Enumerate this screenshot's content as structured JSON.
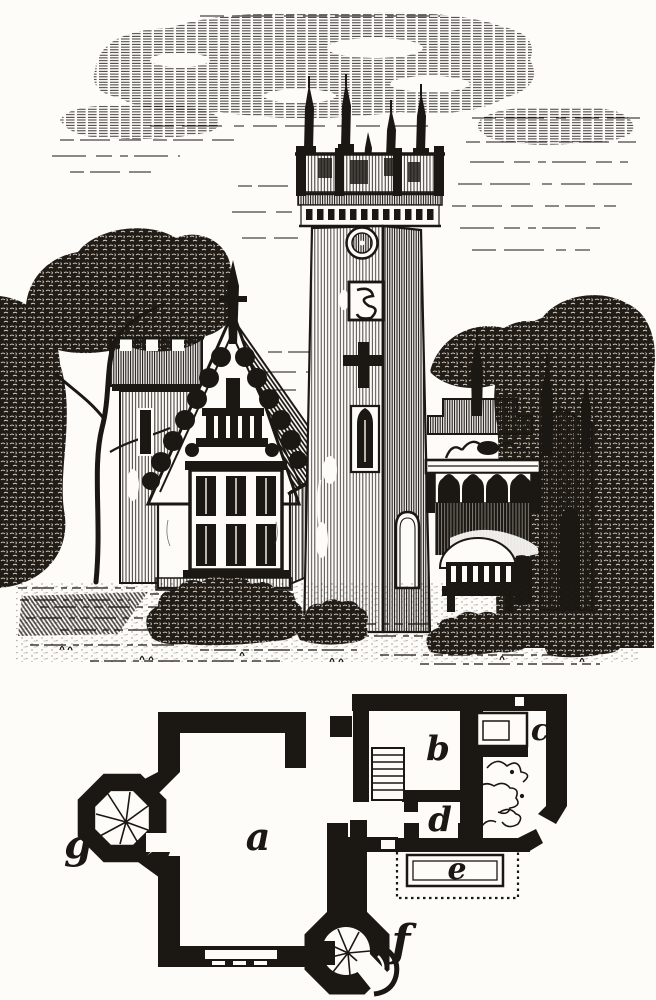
{
  "figure": {
    "kind": "wood-engraving of a Gothic lodge with clock tower, above its ground-floor plan",
    "ink": "#1b1713",
    "paper": "#fdfcf9"
  },
  "plan": {
    "labels": [
      {
        "letter": "a"
      },
      {
        "letter": "b"
      },
      {
        "letter": "c"
      },
      {
        "letter": "d"
      },
      {
        "letter": "e"
      },
      {
        "letter": "f"
      },
      {
        "letter": "g"
      }
    ],
    "features": [
      {
        "name": "spiral-stair-turret-g"
      },
      {
        "name": "spiral-stair-turret-f"
      },
      {
        "name": "straight-stair"
      },
      {
        "name": "veranda-seat"
      },
      {
        "name": "dotted-veranda-outline"
      },
      {
        "name": "shrub-sketch"
      }
    ]
  }
}
